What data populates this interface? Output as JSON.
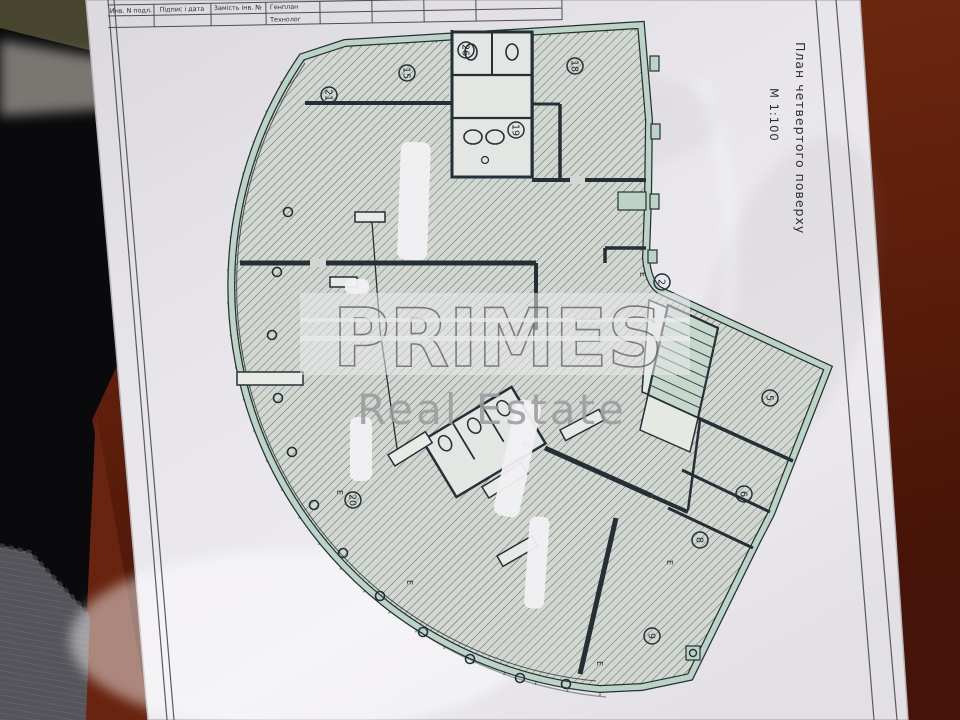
{
  "palette": {
    "floor": "#6e2610",
    "floor_dark": "#451307",
    "shadow": "#0a0a0c",
    "fabric": "#56565b",
    "olive": "#48452f",
    "paper": "#e8e6eb",
    "wall_green": "#bdd3c6",
    "wall_dark": "#243038",
    "hatch_bg": "#d2d7d1",
    "hatch_line": "#49534c",
    "watermark_gray": "#636361"
  },
  "sheet": {
    "title_block": {
      "c1": "Инв. N подл.",
      "c2": "Підпис і дата",
      "c3": "Замість інв. №",
      "c4a": "Генплан",
      "c4b": "Технолог"
    },
    "side_title": "План четвертого поверху",
    "scale": "М 1:100"
  },
  "watermark": {
    "line1": "PRIMES",
    "line2": "Real Estate"
  },
  "plan": {
    "marker": "Е",
    "rooms": [
      "21",
      "15",
      "26",
      "18",
      "19",
      "2",
      "5",
      "6",
      "8",
      "9",
      "20"
    ]
  }
}
